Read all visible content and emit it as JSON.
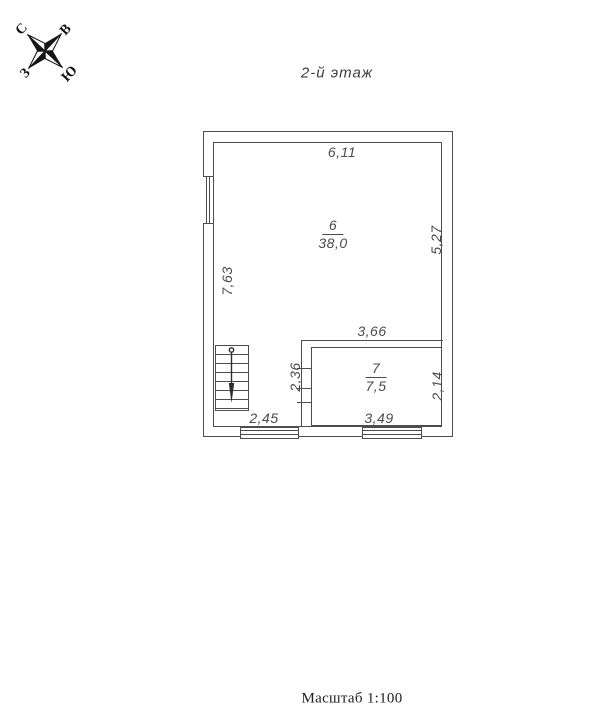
{
  "title": "2-й этаж",
  "scale_label": "Масштаб 1:100",
  "compass": {
    "north": "С",
    "east": "В",
    "south": "Ю",
    "west": "З"
  },
  "rooms": [
    {
      "number": "6",
      "area": "38,0"
    },
    {
      "number": "7",
      "area": "7,5"
    }
  ],
  "dimensions": {
    "top_width": "6,11",
    "right_height": "5,27",
    "left_height": "7,63",
    "mid_wall_width": "3,66",
    "inner_wall_height": "2,36",
    "room7_height": "2,14",
    "bottom_left_width": "2,45",
    "room7_width": "3,49"
  },
  "colors": {
    "wall": "#4d4d4d",
    "text": "#4a4a4a"
  }
}
